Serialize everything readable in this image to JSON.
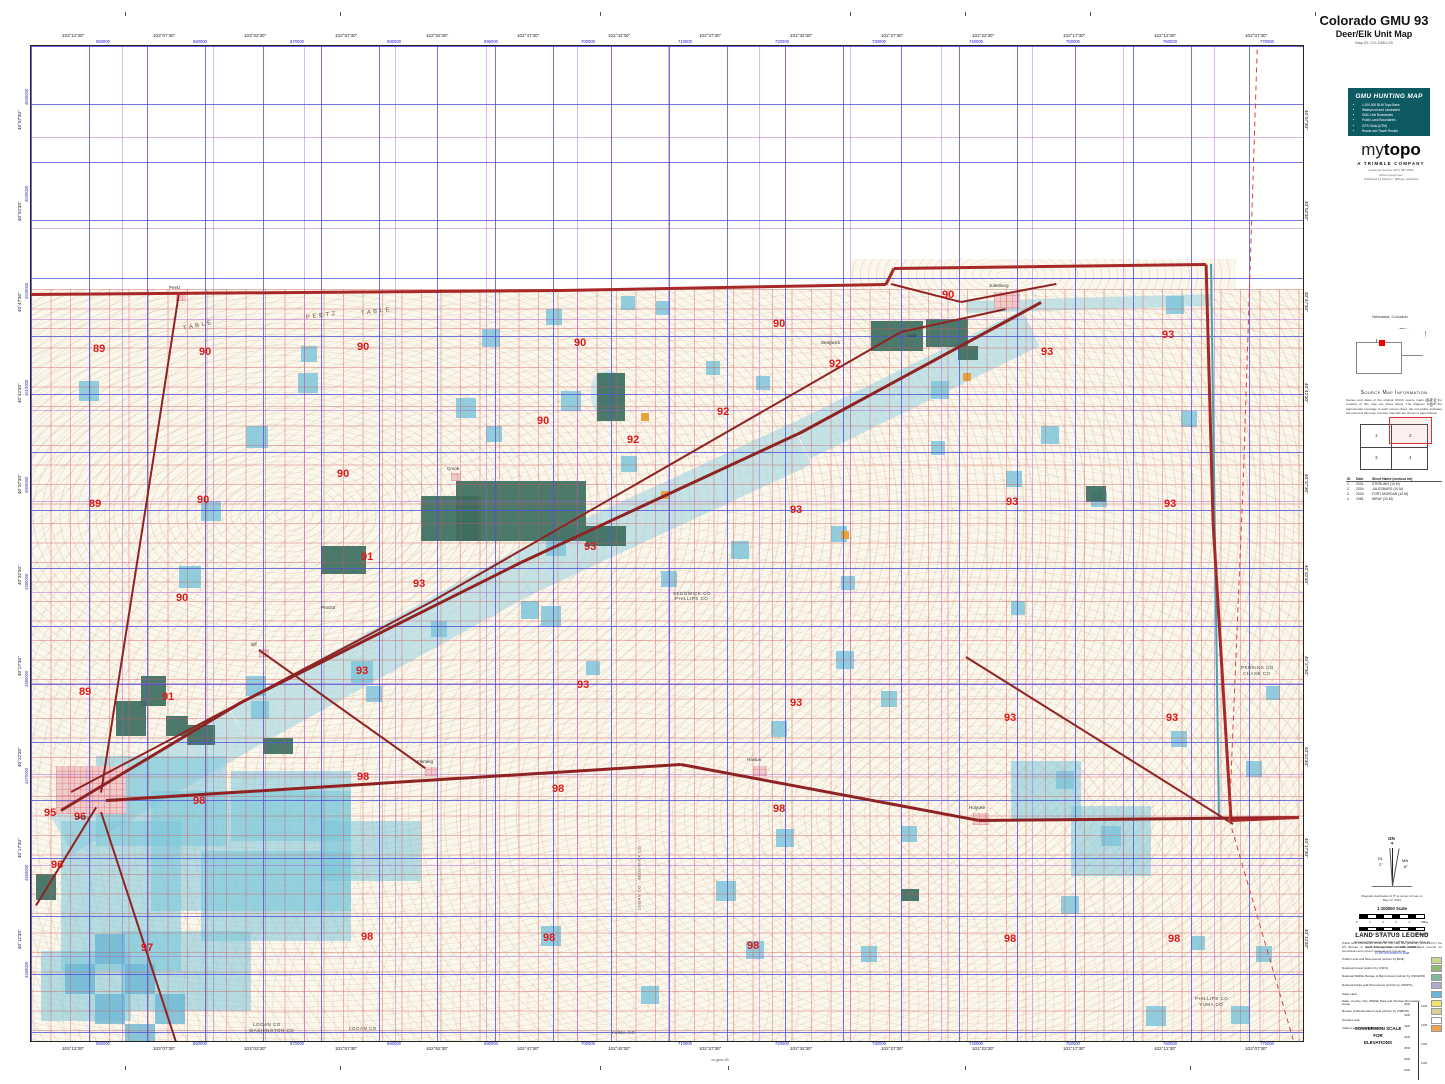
{
  "header": {
    "title": "Colorado GMU 93",
    "subtitle": "Deer/Elk Unit Map",
    "map_id": "Map ID: CO-GMU-93"
  },
  "gmu_box": {
    "heading": "GMU HUNTING MAP",
    "bullets": [
      "1:100,000 BLM Topo Base",
      "Waterproof and Laminated",
      "GMU Unit Boundaries",
      "Public Land Boundaries",
      "GPS Grids (UTM)",
      "Roads and Travel Routes"
    ]
  },
  "logo": {
    "my": "my",
    "topo": "topo",
    "company": "A TRIMBLE COMPANY",
    "lines": [
      "Customer Service (877) 587-9004",
      "www.mytopo.com",
      "Published by MyTopo · Billings, Montana"
    ]
  },
  "inset": {
    "label": "Nebraska, Colorado"
  },
  "source": {
    "heading": "Source Map Information",
    "paragraph": "Names and dates of the original USGS source maps used in the creation of this map are listed below. The diagram shows the approximate coverage of each source sheet; the red outline indicates the extent of this map. Contour intervals are shown in parentheses.",
    "cells": [
      "1",
      "2",
      "3",
      "4"
    ],
    "table_header": [
      "ID",
      "Date",
      "Sheet Name (contour int)"
    ],
    "rows": [
      [
        "1",
        "2001",
        "STERLING (10 M)"
      ],
      [
        "2",
        "2004",
        "JULESBURG (10 M)"
      ],
      [
        "3",
        "2000",
        "FORT MORGAN (10 M)"
      ],
      [
        "4",
        "1981",
        "WRAY (10 M)"
      ]
    ],
    "vertical_label": "CO GMU 93"
  },
  "declination": {
    "gn": "GN",
    "tn": "TN",
    "tn_deg": "2°",
    "mn": "MN",
    "mn_deg": "8°",
    "note1": "Magnetic declination of 8° at center of map on",
    "note2": "May 12, 2021",
    "scale_title": "1:100000 Scale",
    "miles_labels": [
      "0",
      "1",
      "2",
      "3",
      "4"
    ],
    "miles_unit": "Miles",
    "km_labels": [
      "0",
      "1",
      "2",
      "3",
      "4",
      "5",
      "6"
    ],
    "km_unit": "Kilometers",
    "proj1": "Universal Transverse Mercator (UTM) Projection Zone 13",
    "proj2": "North American Datum of 1983 (NAD83)",
    "utm_note": "UTM Grid shown in Blue"
  },
  "legend": {
    "heading": "LAND STATUS LEGEND",
    "paragraph": "Public land boundaries shown on this map are generally produced by the US Bureau of Land Management. Consult official land records for boundaries and current management resources.",
    "items": [
      {
        "label": "Public Land and Monuments (Admin by BLM)",
        "color": "#cdd98f"
      },
      {
        "label": "National Forest (Admin by USFS)",
        "color": "#8fbc72"
      },
      {
        "label": "National Wildlife Refuge & Mgmt Areas (Admin by USF&WS)",
        "color": "#7fb99a"
      },
      {
        "label": "National Parks and Monuments (Admin by USNPS)",
        "color": "#b5a6cf"
      },
      {
        "label": "State Land",
        "color": "#6fb4d9"
      },
      {
        "label": "State, County, City, Wildlife Park and Outdoor Recreation Areas",
        "color": "#f0e26b"
      },
      {
        "label": "Bureau of Reclamation Land (Admin by USBOR)",
        "color": "#d9cf9b"
      },
      {
        "label": "Private Land",
        "color": "#ffffff"
      },
      {
        "label": "Indian Lands or Reservations",
        "color": "#f0a44c"
      }
    ]
  },
  "conversion": {
    "heading1": "CONVERSION SCALE",
    "heading2": "FOR",
    "heading3": "ELEVATIONS",
    "feet": [
      "4600",
      "4400",
      "4200",
      "4000",
      "3800",
      "3600",
      "3400"
    ],
    "meters": [
      "1400",
      "1300",
      "1200",
      "1100"
    ]
  },
  "page": {
    "bottom_label": "co-gmu-93"
  },
  "edges": {
    "top_black": [
      "103°12'30\"",
      "103°07'30\"",
      "103°02'30\"",
      "102°57'30\"",
      "102°52'30\"",
      "102°47'30\"",
      "102°42'30\"",
      "102°37'30\"",
      "102°32'30\"",
      "102°27'30\"",
      "102°22'30\"",
      "102°17'30\"",
      "102°12'30\"",
      "102°07'30\""
    ],
    "top_blue": [
      "650000",
      "660000",
      "670000",
      "680000",
      "690000",
      "700000",
      "710000",
      "720000",
      "730000",
      "740000",
      "750000",
      "760000",
      "770000"
    ],
    "left_black": [
      "40°57'30\"",
      "40°52'30\"",
      "40°47'30\"",
      "40°42'30\"",
      "40°37'30\"",
      "40°32'30\"",
      "40°27'30\"",
      "40°22'30\"",
      "40°17'30\"",
      "40°12'30\""
    ],
    "left_blue": [
      "4540000",
      "4530000",
      "4520000",
      "4510000",
      "4500000",
      "4490000",
      "4480000",
      "4470000",
      "4460000",
      "4450000"
    ]
  },
  "map": {
    "colors": {
      "gmu_number": "#e01818",
      "road": "#8f2323",
      "boundary": "#a82828",
      "dashed_line": "#e04040",
      "sheet_line": "#4aa0b0",
      "state_land": "#7ec5da",
      "state_cluster": "rgba(122,198,218,0.55)",
      "checker": "#6db7d4",
      "wildlife": "#3c6e60",
      "water": "rgba(168,216,228,0.65)",
      "pond": "#cfe8ee",
      "reclamation": "#e8a23a",
      "urban": "#f2c9c9"
    },
    "gmu_numbers": [
      [
        "89",
        62,
        297
      ],
      [
        "89",
        58,
        452
      ],
      [
        "89",
        48,
        640
      ],
      [
        "90",
        168,
        300
      ],
      [
        "90",
        326,
        295
      ],
      [
        "90",
        543,
        291
      ],
      [
        "90",
        506,
        369
      ],
      [
        "90",
        306,
        422
      ],
      [
        "90",
        166,
        448
      ],
      [
        "90",
        145,
        546
      ],
      [
        "90",
        742,
        272
      ],
      [
        "90",
        911,
        243
      ],
      [
        "91",
        330,
        505
      ],
      [
        "91",
        131,
        645
      ],
      [
        "92",
        798,
        312
      ],
      [
        "92",
        686,
        360
      ],
      [
        "92",
        596,
        388
      ],
      [
        "93",
        1131,
        283
      ],
      [
        "93",
        1010,
        300
      ],
      [
        "93",
        1133,
        452
      ],
      [
        "93",
        975,
        450
      ],
      [
        "93",
        759,
        458
      ],
      [
        "93",
        553,
        495
      ],
      [
        "93",
        382,
        532
      ],
      [
        "93",
        325,
        619
      ],
      [
        "93",
        546,
        633
      ],
      [
        "93",
        759,
        651
      ],
      [
        "93",
        973,
        666
      ],
      [
        "93",
        1135,
        666
      ],
      [
        "95",
        13,
        761
      ],
      [
        "96",
        43,
        765
      ],
      [
        "96",
        20,
        813
      ],
      [
        "97",
        110,
        896
      ],
      [
        "98",
        162,
        749
      ],
      [
        "98",
        326,
        725
      ],
      [
        "98",
        521,
        737
      ],
      [
        "98",
        742,
        757
      ],
      [
        "98",
        330,
        885
      ],
      [
        "98",
        512,
        886
      ],
      [
        "98",
        716,
        894
      ],
      [
        "98",
        973,
        887
      ],
      [
        "98",
        1137,
        887
      ]
    ],
    "places": [
      [
        "P E E T Z",
        275,
        267,
        6,
        "#6b5b3e",
        -8
      ],
      [
        "T A B L E",
        330,
        263,
        6,
        "#6b5b3e",
        -8
      ],
      [
        "T A B L E",
        152,
        277,
        6,
        "#6b5b3e",
        -12
      ],
      [
        "SEDGWICK CO",
        642,
        546,
        4.5,
        "#444",
        0
      ],
      [
        "PHILLIPS CO",
        644,
        551,
        4.5,
        "#444",
        0
      ],
      [
        "PERKINS CO",
        1210,
        620,
        4.5,
        "#444",
        0
      ],
      [
        "CHASE CO",
        1212,
        626,
        4.5,
        "#444",
        0
      ],
      [
        "LOGAN CO",
        222,
        977,
        4.5,
        "#444",
        0
      ],
      [
        "WASHINGTON CO",
        218,
        983,
        4.5,
        "#444",
        0
      ],
      [
        "LOGAN CO",
        318,
        981,
        4.5,
        "#444",
        0
      ],
      [
        "YUMA CO",
        580,
        985,
        4.5,
        "#444",
        0
      ],
      [
        "PHILLIPS CO",
        1164,
        951,
        4.5,
        "#444",
        0
      ],
      [
        "YUMA CO",
        1168,
        957,
        4.5,
        "#444",
        0
      ],
      [
        "LOGAN CO · SEDGWICK CO",
        576,
        830,
        4,
        "#444",
        -90
      ],
      [
        "Sterling",
        44,
        770,
        4.5,
        "#333",
        0
      ],
      [
        "Julesburg",
        958,
        238,
        4.5,
        "#333",
        0
      ],
      [
        "Crook",
        416,
        421,
        4.5,
        "#333",
        0
      ],
      [
        "Iliff",
        220,
        597,
        4.5,
        "#333",
        0
      ],
      [
        "Fleming",
        386,
        714,
        4.5,
        "#333",
        0
      ],
      [
        "Haxtun",
        716,
        712,
        4.5,
        "#333",
        0
      ],
      [
        "Holyoke",
        938,
        760,
        4.5,
        "#333",
        0
      ],
      [
        "Peetz",
        138,
        240,
        4.5,
        "#333",
        0
      ],
      [
        "Sedgwick",
        790,
        295,
        4.5,
        "#333",
        0
      ],
      [
        "Ovid",
        876,
        288,
        4.5,
        "#333",
        0
      ],
      [
        "Proctor",
        290,
        560,
        4.5,
        "#333",
        0
      ]
    ],
    "state_squares": [
      [
        48,
        335,
        20
      ],
      [
        148,
        520,
        22
      ],
      [
        170,
        455,
        20
      ],
      [
        215,
        380,
        22
      ],
      [
        267,
        327,
        20
      ],
      [
        425,
        352,
        20
      ],
      [
        451,
        283,
        18
      ],
      [
        515,
        263,
        16
      ],
      [
        530,
        345,
        20
      ],
      [
        590,
        250,
        14
      ],
      [
        625,
        255,
        14
      ],
      [
        510,
        560,
        20
      ],
      [
        320,
        615,
        22
      ],
      [
        215,
        630,
        20
      ],
      [
        220,
        655,
        18
      ],
      [
        515,
        490,
        20
      ],
      [
        490,
        555,
        18
      ],
      [
        630,
        525,
        16
      ],
      [
        700,
        495,
        18
      ],
      [
        800,
        480,
        16
      ],
      [
        900,
        335,
        18
      ],
      [
        975,
        425,
        16
      ],
      [
        1010,
        380,
        18
      ],
      [
        1060,
        445,
        16
      ],
      [
        1135,
        250,
        18
      ],
      [
        1150,
        365,
        16
      ],
      [
        805,
        605,
        18
      ],
      [
        850,
        645,
        16
      ],
      [
        980,
        555,
        14
      ],
      [
        1025,
        725,
        18
      ],
      [
        1070,
        780,
        20
      ],
      [
        1140,
        685,
        16
      ],
      [
        1215,
        715,
        16
      ],
      [
        1235,
        640,
        14
      ],
      [
        740,
        675,
        16
      ],
      [
        745,
        783,
        18
      ],
      [
        685,
        835,
        20
      ],
      [
        715,
        895,
        18
      ],
      [
        510,
        880,
        20
      ],
      [
        610,
        940,
        18
      ],
      [
        830,
        900,
        16
      ],
      [
        870,
        780,
        16
      ],
      [
        1030,
        850,
        18
      ],
      [
        1115,
        960,
        20
      ],
      [
        1200,
        960,
        18
      ],
      [
        1225,
        900,
        16
      ],
      [
        1160,
        890,
        14
      ],
      [
        270,
        300,
        16
      ],
      [
        455,
        380,
        16
      ],
      [
        590,
        410,
        16
      ],
      [
        675,
        315,
        14
      ],
      [
        725,
        330,
        14
      ],
      [
        900,
        395,
        14
      ],
      [
        810,
        530,
        14
      ],
      [
        400,
        575,
        16
      ],
      [
        335,
        640,
        16
      ],
      [
        555,
        615,
        14
      ]
    ],
    "clusters": [
      [
        65,
        710,
        130,
        90
      ],
      [
        120,
        745,
        200,
        120
      ],
      [
        30,
        775,
        120,
        150
      ],
      [
        170,
        805,
        150,
        90
      ],
      [
        90,
        885,
        130,
        80
      ],
      [
        200,
        725,
        120,
        70
      ],
      [
        290,
        775,
        100,
        60
      ],
      [
        10,
        905,
        90,
        70
      ],
      [
        980,
        715,
        70,
        60
      ],
      [
        1040,
        760,
        80,
        70
      ]
    ],
    "checkers": [
      [
        34,
        918,
        30
      ],
      [
        64,
        948,
        30
      ],
      [
        94,
        918,
        30
      ],
      [
        124,
        948,
        30
      ],
      [
        64,
        888,
        30
      ],
      [
        94,
        978,
        30
      ]
    ],
    "wildlife": [
      [
        290,
        500,
        45,
        28
      ],
      [
        390,
        450,
        60,
        45
      ],
      [
        425,
        435,
        130,
        60
      ],
      [
        555,
        480,
        40,
        20
      ],
      [
        566,
        327,
        28,
        48
      ],
      [
        85,
        655,
        30,
        35
      ],
      [
        110,
        630,
        25,
        30
      ],
      [
        135,
        670,
        22,
        20
      ],
      [
        156,
        679,
        28,
        20
      ],
      [
        840,
        275,
        52,
        30
      ],
      [
        895,
        273,
        42,
        28
      ],
      [
        927,
        300,
        20,
        14
      ],
      [
        1055,
        440,
        20,
        16
      ],
      [
        870,
        843,
        18,
        12
      ],
      [
        5,
        828,
        20,
        26
      ],
      [
        232,
        692,
        30,
        16
      ]
    ],
    "orange": [
      [
        610,
        367
      ],
      [
        630,
        445
      ],
      [
        810,
        485
      ],
      [
        932,
        327
      ]
    ],
    "urban": [
      [
        25,
        720,
        70,
        48
      ],
      [
        963,
        246,
        26,
        16
      ],
      [
        942,
        767,
        16,
        12
      ],
      [
        722,
        720,
        14,
        10
      ],
      [
        394,
        721,
        12,
        9
      ],
      [
        228,
        603,
        10,
        8
      ],
      [
        420,
        427,
        10,
        8
      ],
      [
        145,
        247,
        10,
        8
      ]
    ],
    "water_bands": [
      [
        30,
        765,
        210,
        660,
        46
      ],
      [
        210,
        660,
        490,
        505,
        46
      ],
      [
        490,
        505,
        770,
        375,
        46
      ],
      [
        770,
        375,
        1000,
        262,
        40
      ],
      [
        935,
        255,
        1180,
        248,
        12
      ]
    ],
    "ponds": [
      [
        560,
        325,
        34,
        44
      ]
    ],
    "roads": [
      [
        30,
        763,
        210,
        655,
        3
      ],
      [
        210,
        655,
        490,
        515,
        3
      ],
      [
        490,
        515,
        770,
        385,
        3
      ],
      [
        770,
        385,
        1010,
        255,
        3
      ],
      [
        40,
        745,
        400,
        555,
        1.8
      ],
      [
        400,
        555,
        870,
        285,
        1.8
      ],
      [
        870,
        285,
        975,
        262,
        1.8
      ],
      [
        148,
        245,
        128,
        375,
        2.2
      ],
      [
        128,
        375,
        70,
        745,
        2.2
      ],
      [
        75,
        753,
        650,
        717,
        3
      ],
      [
        650,
        717,
        948,
        773,
        3
      ],
      [
        948,
        773,
        1268,
        770,
        3
      ],
      [
        935,
        610,
        1202,
        777,
        2
      ],
      [
        860,
        237,
        930,
        255,
        2.2
      ],
      [
        930,
        255,
        1025,
        237,
        2.2
      ],
      [
        65,
        760,
        5,
        858,
        2.4
      ],
      [
        70,
        765,
        145,
        995,
        2
      ],
      [
        228,
        603,
        394,
        721,
        1.6
      ]
    ],
    "boundary": [
      [
        0,
        247,
        530,
        243,
        3.2
      ],
      [
        530,
        243,
        855,
        237,
        3.2
      ],
      [
        855,
        237,
        863,
        221,
        3.2
      ],
      [
        863,
        221,
        1175,
        217,
        3.2
      ],
      [
        1175,
        217,
        1182,
        475,
        3.2
      ],
      [
        1182,
        475,
        1200,
        773,
        3.2
      ],
      [
        1200,
        773,
        1268,
        770,
        3.2
      ]
    ],
    "sheet_lines": [
      [
        1180,
        217,
        1188,
        773,
        2
      ]
    ],
    "dashed": [
      [
        1226,
        3,
        1212,
        435,
        1.4
      ],
      [
        1212,
        435,
        1198,
        773,
        1.4
      ],
      [
        1198,
        773,
        1262,
        993,
        1.4
      ]
    ]
  }
}
